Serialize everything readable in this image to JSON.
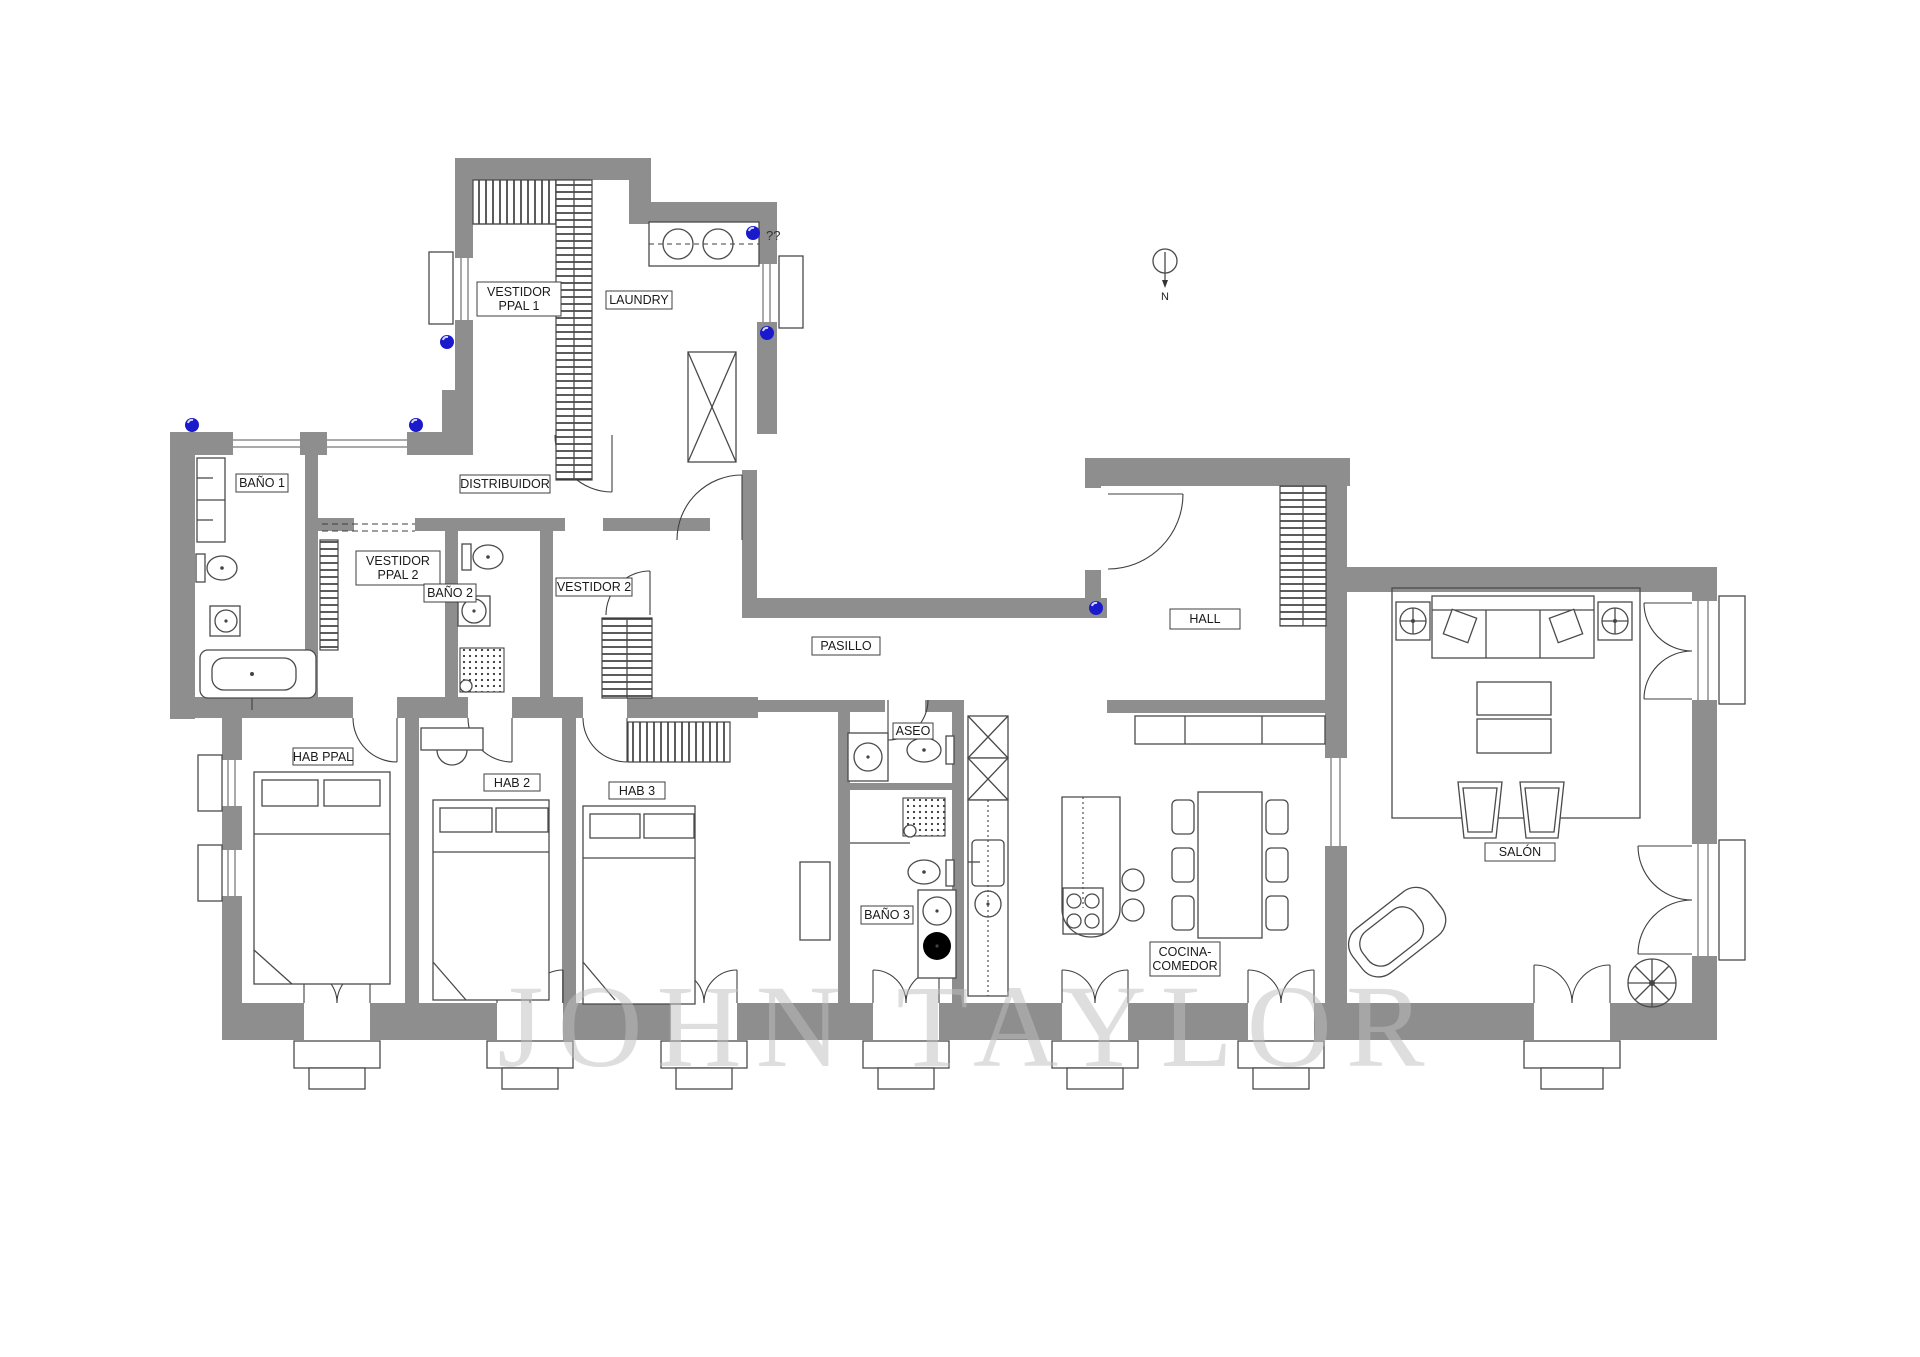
{
  "plan": {
    "room_labels": {
      "vestidor_ppal_1_l1": "VESTIDOR",
      "vestidor_ppal_1_l2": "PPAL 1",
      "laundry": "LAUNDRY",
      "bano_1": "BAÑO 1",
      "vestidor_ppal_2_l1": "VESTIDOR",
      "vestidor_ppal_2_l2": "PPAL 2",
      "bano_2": "BAÑO 2",
      "vestidor_2": "VESTIDOR 2",
      "distribuidor": "DISTRIBUIDOR",
      "pasillo": "PASILLO",
      "hall": "HALL",
      "hab_ppal": "HAB PPAL",
      "hab_2": "HAB 2",
      "hab_3": "HAB 3",
      "aseo": "ASEO",
      "bano_3": "BAÑO 3",
      "cocina_l1": "COCINA-",
      "cocina_l2": "COMEDOR",
      "salon": "SALÓN"
    },
    "annotations": {
      "unknown_marker": "??",
      "compass_north": "N"
    },
    "watermark": "JOHN TAYLOR",
    "colors": {
      "wall_gray": "#8e8e8e",
      "line_dark": "#4a4a4a",
      "marker_blue": "#1a1acc",
      "watermark_gray": "#bfbfbf"
    }
  }
}
